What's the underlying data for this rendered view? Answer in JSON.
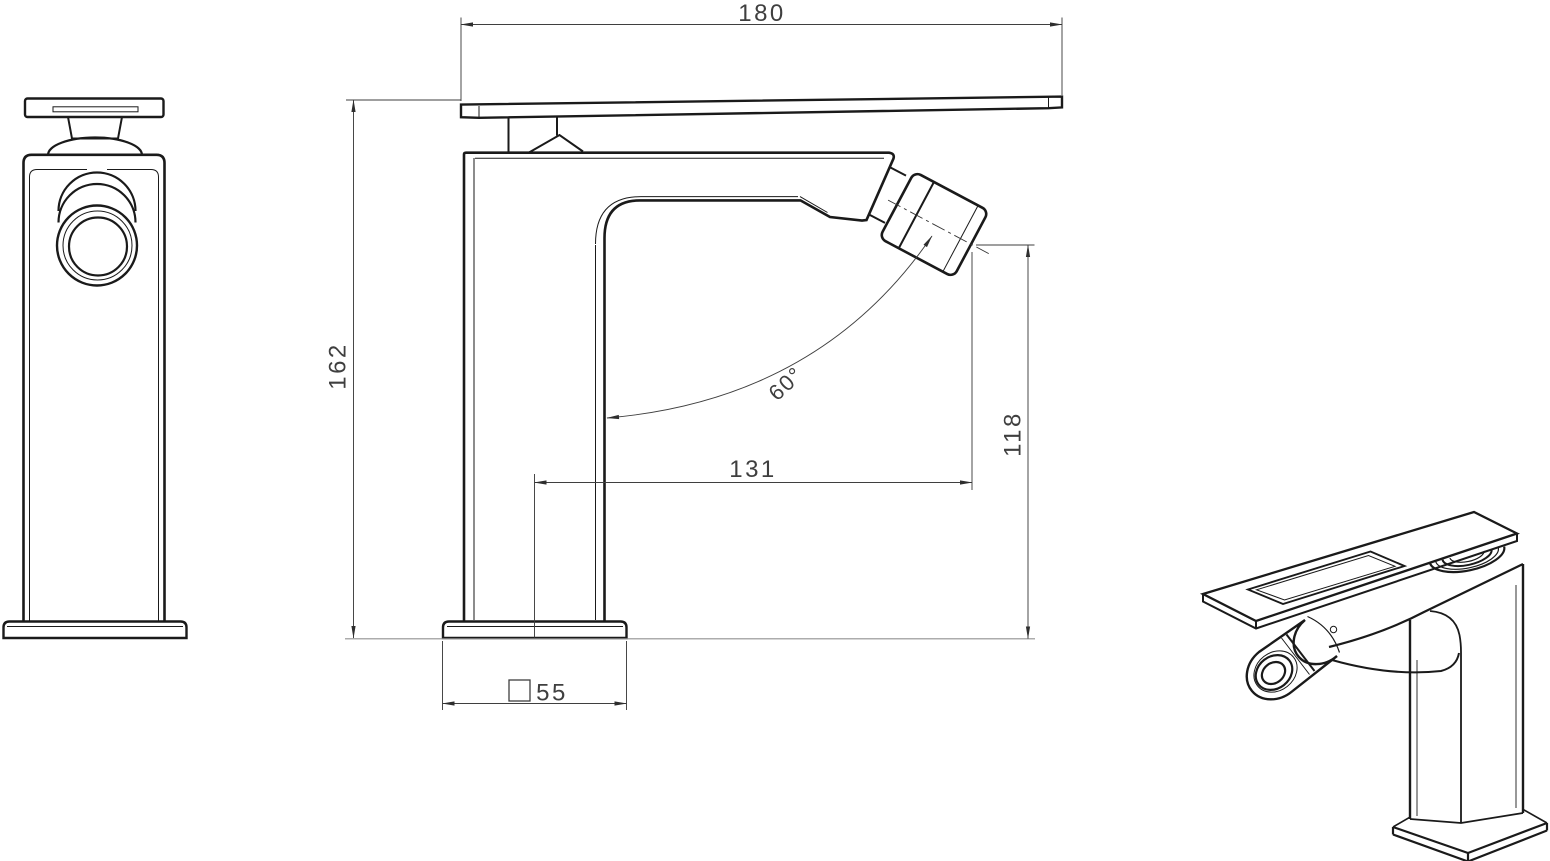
{
  "document": {
    "background_color": "#ffffff",
    "line_color": "#1a1a1a",
    "dimension_color": "#3f3f3f",
    "counter_line_color": "#909090"
  },
  "dimensions": {
    "handle_length": "180",
    "overall_height": "162",
    "spout_reach": "131",
    "outlet_height": "118",
    "spout_angle": "60°",
    "base_width": "55"
  }
}
